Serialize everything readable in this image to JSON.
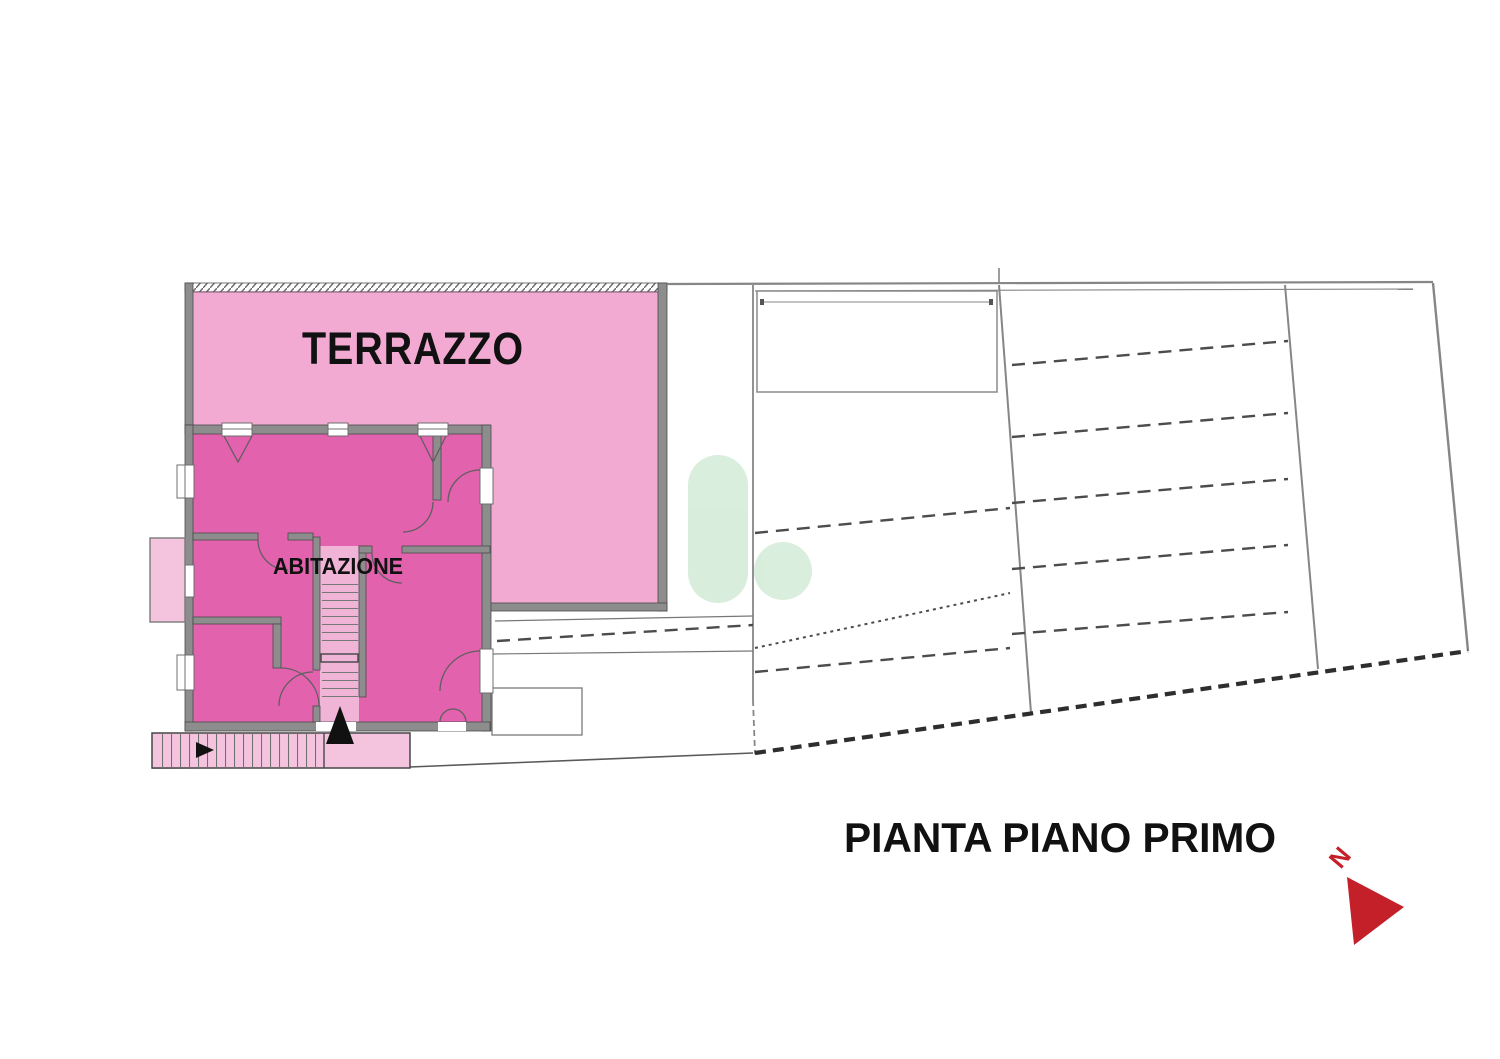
{
  "floor_plan": {
    "title": "PIANTA PIANO PRIMO",
    "rooms": {
      "terrace": {
        "label": "TERRAZZO",
        "fill": "#f2a9d2"
      },
      "dwelling": {
        "label": "ABITAZIONE",
        "fill": "#e262ad"
      }
    },
    "stairs_fill": "#f4c3de",
    "stair_shaft_fill": "#efb4d6",
    "wall_color": "#8d8d8d",
    "line_color": "#6f6f6f",
    "hatch_color": "#4a4a4a",
    "watermark_color": "#d8eddb",
    "compass": {
      "label": "N",
      "color": "#c3202a"
    },
    "label_color": "#111111"
  }
}
